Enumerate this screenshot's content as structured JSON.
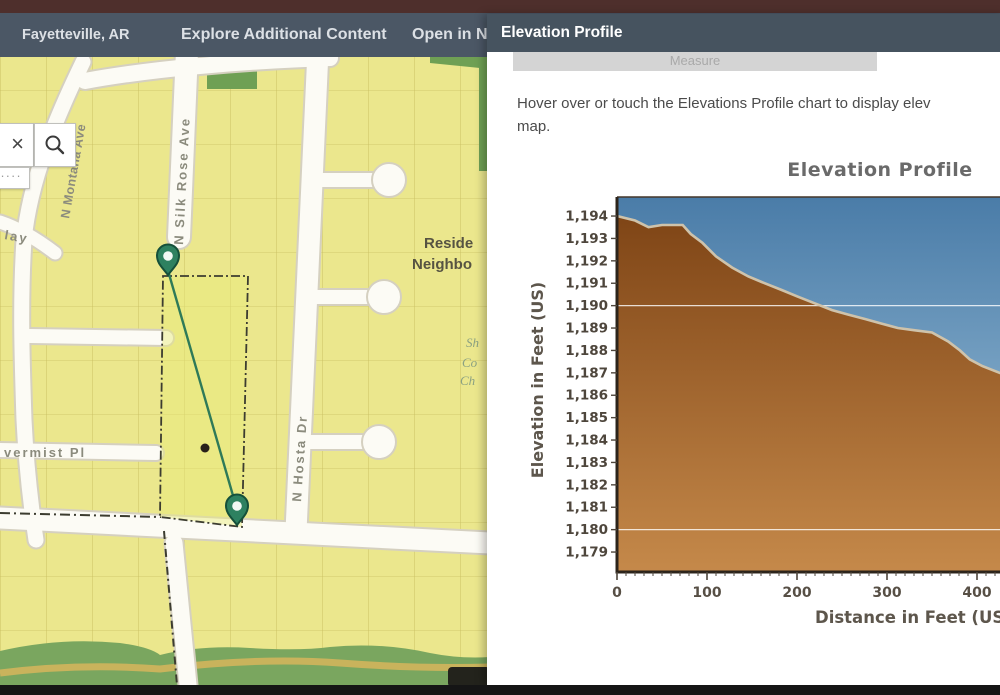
{
  "header": {
    "location": "Fayetteville, AR",
    "menu_explore": "Explore Additional Content",
    "menu_open": "Open in N"
  },
  "map": {
    "search": {
      "clear_icon": "×",
      "handle_dots": "····"
    },
    "streets": {
      "montana": "N Montana Ave",
      "silk_rose": "N Silk Rose Ave",
      "hosta": "N Hosta Dr",
      "lay": "lay",
      "vermist": "vermist Pl"
    },
    "areas": {
      "residential_1": "Reside",
      "residential_2": "Neighbo",
      "church_1": "Sh",
      "church_2": "Co",
      "church_3": "Ch"
    }
  },
  "panel": {
    "title": "Elevation Profile",
    "tab_label": "Measure",
    "note_line_1": "Hover over or touch the Elevations Profile chart to display elev",
    "note_line_2": "map."
  },
  "chart_data": {
    "type": "area",
    "title": "Elevation Profile",
    "xlabel": "Distance in Feet (US)",
    "ylabel": "Elevation in Feet (US)",
    "x_ticks": [
      0,
      100,
      200,
      300,
      400,
      500
    ],
    "y_ticks": [
      1179,
      1180,
      1181,
      1182,
      1183,
      1184,
      1185,
      1186,
      1187,
      1188,
      1189,
      1190,
      1191,
      1192,
      1193,
      1194
    ],
    "xlim": [
      0,
      450
    ],
    "ylim": [
      1178,
      1195
    ],
    "grid_y": [
      1180,
      1190
    ],
    "points": [
      [
        0,
        1194.0
      ],
      [
        20,
        1193.8
      ],
      [
        35,
        1193.5
      ],
      [
        50,
        1193.6
      ],
      [
        73,
        1193.6
      ],
      [
        82,
        1193.2
      ],
      [
        95,
        1192.8
      ],
      [
        110,
        1192.2
      ],
      [
        128,
        1191.7
      ],
      [
        146,
        1191.3
      ],
      [
        164,
        1191.0
      ],
      [
        183,
        1190.7
      ],
      [
        201,
        1190.4
      ],
      [
        220,
        1190.1
      ],
      [
        239,
        1189.8
      ],
      [
        257,
        1189.6
      ],
      [
        276,
        1189.4
      ],
      [
        294,
        1189.2
      ],
      [
        312,
        1189.0
      ],
      [
        331,
        1188.9
      ],
      [
        350,
        1188.8
      ],
      [
        368,
        1188.4
      ],
      [
        381,
        1188.0
      ],
      [
        392,
        1187.6
      ],
      [
        406,
        1187.3
      ],
      [
        425,
        1187.0
      ],
      [
        450,
        1186.6
      ]
    ],
    "colors": {
      "sky_top": "#4a7ca8",
      "sky_bottom": "#a5c8de",
      "ground_top": "#7f4516",
      "ground_bottom": "#c5894a",
      "profile_stroke": "#cfc3ab",
      "axis": "#2c241b"
    }
  }
}
